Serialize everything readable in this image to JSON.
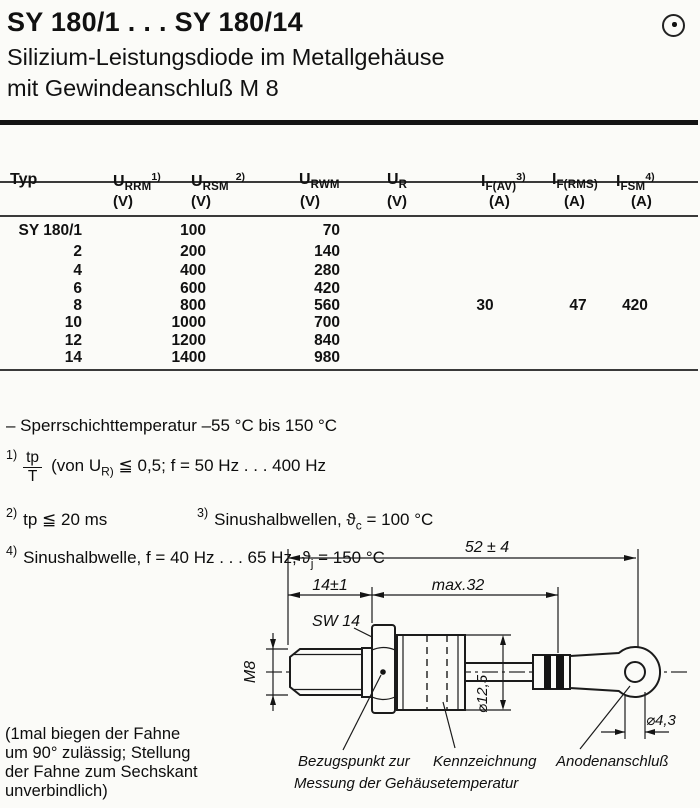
{
  "header": {
    "title": "SY 180/1 . . . SY 180/14",
    "subtitle_line1": "Silizium-Leistungsdiode im Metallgehäuse",
    "subtitle_line2": "mit Gewindeanschluß M 8"
  },
  "table": {
    "headers": {
      "typ": "Typ",
      "urrm": {
        "main": "U",
        "sub": "RRM",
        "sup": "1)",
        "unit": "(V)"
      },
      "ursm": {
        "main": "U",
        "sub": "RSM",
        "sup": "2)",
        "unit": "(V)"
      },
      "urwm": {
        "main": "U",
        "sub": "RWM",
        "sup": "",
        "unit": "(V)"
      },
      "ur": {
        "main": "U",
        "sub": "R",
        "sup": "",
        "unit": "(V)"
      },
      "ifav": {
        "main": "I",
        "sub": "F(AV)",
        "sup": "3)",
        "unit": "(A)"
      },
      "ifrms": {
        "main": "I",
        "sub": "F(RMS)",
        "sup": "",
        "unit": "(A)"
      },
      "ifsm": {
        "main": "I",
        "sub": "FSM",
        "sup": "4)",
        "unit": "(A)"
      }
    },
    "rows": [
      {
        "typ": "SY 180/1",
        "urrm": "100",
        "urwm": "70"
      },
      {
        "typ": "2",
        "urrm": "200",
        "urwm": "140"
      },
      {
        "typ": "4",
        "urrm": "400",
        "urwm": "280"
      },
      {
        "typ": "6",
        "urrm": "600",
        "urwm": "420"
      },
      {
        "typ": "8",
        "urrm": "800",
        "urwm": "560",
        "ifav": "30",
        "ifrms": "47",
        "ifsm": "420"
      },
      {
        "typ": "10",
        "urrm": "1000",
        "urwm": "700"
      },
      {
        "typ": "12",
        "urrm": "1200",
        "urwm": "840"
      },
      {
        "typ": "14",
        "urrm": "1400",
        "urwm": "980"
      }
    ]
  },
  "notes": {
    "temperature": "– Sperrschichttemperatur –55 °C bis 150 °C",
    "fn1": {
      "marker": "1)",
      "frac_top": "tp",
      "frac_bottom": "T",
      "pre": "(von U",
      "sub": "R)",
      "post": " ≦ 0,5;  f = 50 Hz . . . 400 Hz"
    },
    "fn2": {
      "marker": "2)",
      "text": "tp ≦ 20 ms"
    },
    "fn3": {
      "marker": "3)",
      "pre": "Sinushalbwellen,  ϑ",
      "sub": "c",
      "post": " = 100 °C"
    },
    "fn4": {
      "marker": "4)",
      "pre": "Sinushalbwelle,  f = 40 Hz . . . 65 Hz,  ϑ",
      "sub": "j",
      "post": " = 150 °C"
    }
  },
  "drawing": {
    "dim_overall": "52 ± 4",
    "dim_stud": "14±1",
    "dim_body": "max.32",
    "wrench": "SW 14",
    "thread": "M8",
    "dia_body": "⌀12,5",
    "dia_hole": "⌀4,3",
    "label_ref1": "Bezugspunkt zur",
    "label_ref2": "Messung der Gehäusetemperatur",
    "label_marking": "Kennzeichnung",
    "label_anode": "Anodenanschluß"
  },
  "side_note": {
    "line1": "(1mal biegen der Fahne",
    "line2": "um 90° zulässig; Stellung",
    "line3": "der Fahne zum Sechskant",
    "line4": "unverbindlich)"
  }
}
